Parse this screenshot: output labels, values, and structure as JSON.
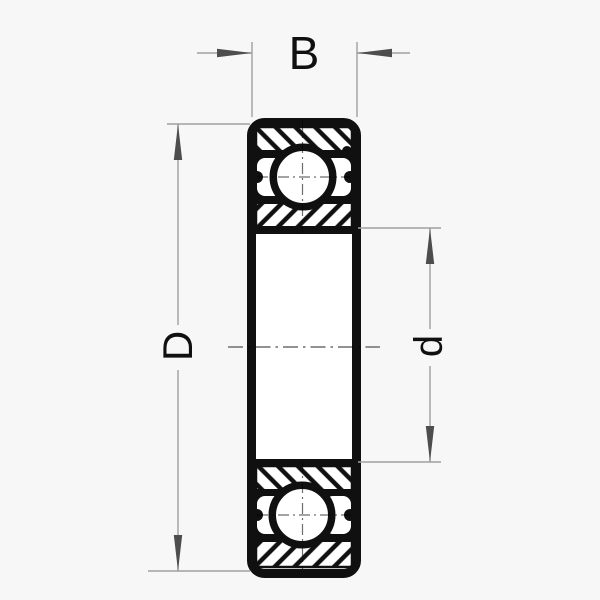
{
  "diagram": {
    "labels": {
      "width": "B",
      "outer_diameter": "D",
      "bore_diameter": "d"
    },
    "colors": {
      "background": "#f7f7f7",
      "paper": "#ffffff",
      "ink": "#101010",
      "dimension_line": "#a0a0a0",
      "arrow": "#4d4d4d",
      "centerline": "#6e6e6e"
    }
  }
}
